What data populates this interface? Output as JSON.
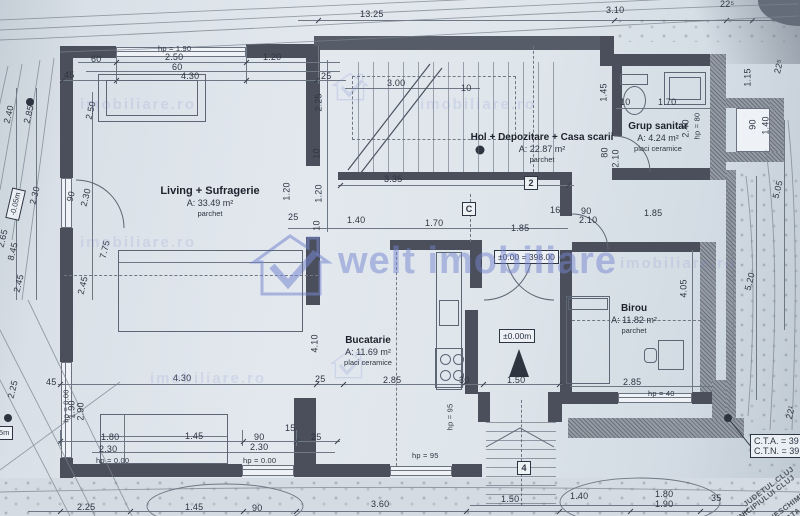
{
  "watermark": {
    "brand": "welt imobiliare",
    "tile": "imobiliare.ro",
    "color": "#7686d0"
  },
  "rooms": {
    "living": {
      "name": "Living + Sufragerie",
      "area": "A: 33.49 m²",
      "floor": "parchet"
    },
    "hol": {
      "name": "Hol + Depozitare + Casa scarii",
      "area": "A: 22.87 m²",
      "floor": "parchet"
    },
    "bath": {
      "name": "Grup sanitar",
      "area": "A: 4.24 m²",
      "floor": "placi ceramice"
    },
    "kitchen": {
      "name": "Bucatarie",
      "area": "A: 11.69 m²",
      "floor": "placi ceramice"
    },
    "office": {
      "name": "Birou",
      "area": "A: 11.82 m²",
      "floor": "parchet"
    }
  },
  "markers": {
    "level_main": "±0.00 = 398.00",
    "level_entry": "±0.00m",
    "level_minus05": "-0.05m",
    "level_minus25": "-0.25m",
    "grid_2": "2",
    "grid_c": "C",
    "grid_4": "4",
    "cta": "C.T.A. = 39",
    "ctn": "C.T.N. = 39"
  },
  "stamp": {
    "line1": "JUDETUL CLUJ",
    "line2": "MUNICIPIULUI CLUJ",
    "line3": "SPRE NESCHIMBARE",
    "line4": "AVIZATA DE"
  },
  "dims": {
    "top_part": "10.25",
    "top_main": "13.25",
    "top_310": "3.10",
    "top_225": "22⁵",
    "lt_hp": "hp = 1.90",
    "lt_250": "2.50",
    "lt_60": "60",
    "lt_430": "4.30",
    "lt_60l": "60",
    "lt_120": "1.20",
    "lt_45": "45",
    "s_25": "25",
    "s_300": "3.00",
    "s_10": "10",
    "s_225": "2.25",
    "s_10v": "10",
    "s_335": "3.35",
    "s_120a": "1.20",
    "s_120b": "1.20",
    "s_140": "1.40",
    "s_170": "1.70",
    "s_25b": "25",
    "s_10b": "10",
    "c_185": "1.85",
    "c_16": "16",
    "c_90": "90",
    "c_210": "2.10",
    "c_185b": "1.85",
    "b_10": "10",
    "b_170": "1.70",
    "b_145": "1.45",
    "b_240": "2.40",
    "b_hp80": "hp = 80",
    "b_90": "90",
    "b_140": "1.40",
    "b_115": "1.15",
    "b_225s": "22⁵",
    "b_80": "80",
    "b_210": "2.10",
    "l_240": "2.40",
    "l_285": "2.85",
    "l_250": "2.50",
    "l_90a": "90",
    "l_230a": "2.30",
    "l_265": "2.65",
    "l_845": "8.45",
    "l_245a": "2.45",
    "l_90b": "90",
    "l_230b": "2.30",
    "l_775": "7.75",
    "l_245b": "2.45",
    "l_225": "2.25",
    "l_45b": "45",
    "l_hp0": "hp = 0.00",
    "l_190": "1.90",
    "l_290": "2.90",
    "k_430": "4.30",
    "k_25": "25",
    "k_285": "2.85",
    "k_30": "30",
    "k_150": "1.50",
    "k_410": "4.10",
    "br_285": "2.85",
    "br_405": "4.05",
    "br_hp40": "hp = 40",
    "r_520": "5.20",
    "r_505": "5.05",
    "r_22": "22¹",
    "bt_180": "1.80",
    "bt_230a": "2.30",
    "bt_hp1": "hp = 0.00",
    "bt_145": "1.45",
    "bt_90": "90",
    "bt_15": "15",
    "bt_25": "25",
    "bt_230b": "2.30",
    "bt_hp2": "hp = 0.00",
    "bt_hp95a": "hp = 95",
    "bt_hp95b": "hp = 95",
    "bb_225": "2.25",
    "bb_145": "1.45",
    "bb_90": "90",
    "bb_360": "3.60",
    "bb_150": "1.50",
    "bb_140": "1.40",
    "bb_180": "1.80",
    "bb_190": "1.90",
    "bb_35": "35"
  }
}
